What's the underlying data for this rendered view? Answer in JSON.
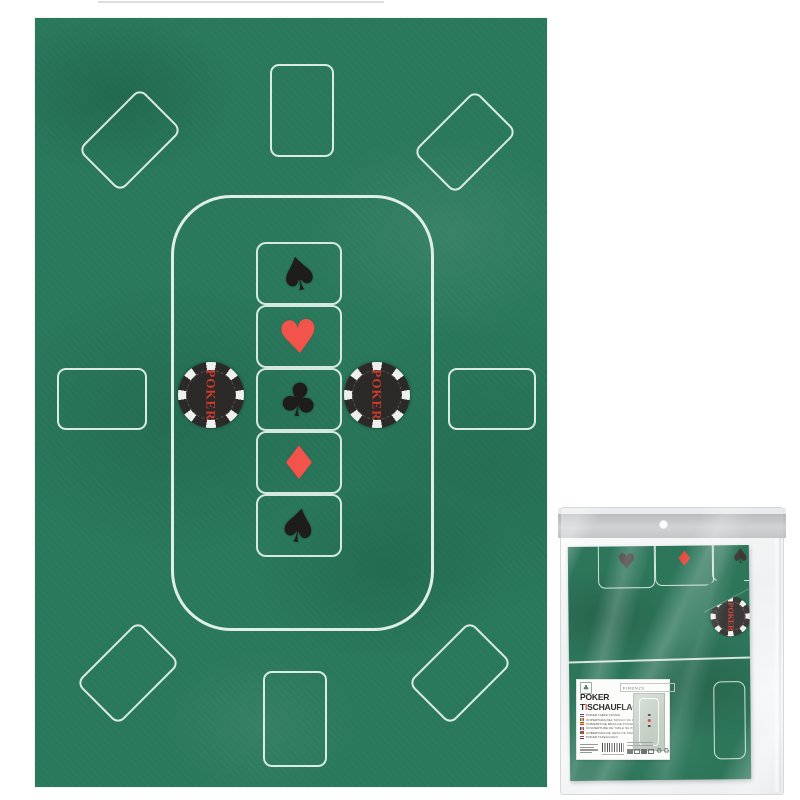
{
  "scene": {
    "background": "#ffffff"
  },
  "mat": {
    "felt_color": "#2b7a5d",
    "line_color": "#e9f4ee",
    "seat_outlines": {
      "corner_diamonds": 4,
      "side_rectangles": 2,
      "end_cards": 2
    },
    "community_cards": [
      {
        "suit": "spade",
        "symbol": "♠",
        "color": "#1f1d1c"
      },
      {
        "suit": "heart",
        "symbol": "♥",
        "color": "#f2544b"
      },
      {
        "suit": "club",
        "symbol": "♣",
        "color": "#1f1d1c"
      },
      {
        "suit": "diamond",
        "symbol": "♦",
        "color": "#f2544b"
      },
      {
        "suit": "spade",
        "symbol": "♠",
        "color": "#1f1d1c"
      }
    ],
    "chip": {
      "label": "POKER",
      "body_color": "#2b2a29",
      "edge_color": "#efefec",
      "text_color": "#cf392d"
    }
  },
  "package": {
    "header_color": "#c0c2c4",
    "bag_color": "#f2f4f5",
    "folded_mat_color": "#1c6b4d",
    "chip_label": "POKER",
    "mat_cards": [
      {
        "suit": "heart",
        "symbol": "♥",
        "color": "#39322f"
      },
      {
        "suit": "diamond",
        "symbol": "♦",
        "color": "#e23b2e"
      },
      {
        "suit": "spade",
        "symbol": "♠",
        "color": "#2c2927"
      }
    ],
    "label": {
      "brand": "FIRENZE",
      "logo_symbol": "♣",
      "title_line1": "POKER",
      "title_line2_t": "T",
      "title_line2_accent": "I",
      "title_line2_rest": "SCHAUFLAGE",
      "languages": [
        {
          "flag": "en",
          "text": "POKER TABLE COVER"
        },
        {
          "flag": "it",
          "text": "COPERTURA DEL TAVOLO DA POKER"
        },
        {
          "flag": "es",
          "text": "CUBIERTA DE MESA DE POKER"
        },
        {
          "flag": "fr",
          "text": "COUVERTURE DE TABLE DE POKER"
        },
        {
          "flag": "pt",
          "text": "COBERTURA DE MESA DE POKER"
        },
        {
          "flag": "nl",
          "text": "POKER TAFELKLEED"
        }
      ]
    }
  }
}
